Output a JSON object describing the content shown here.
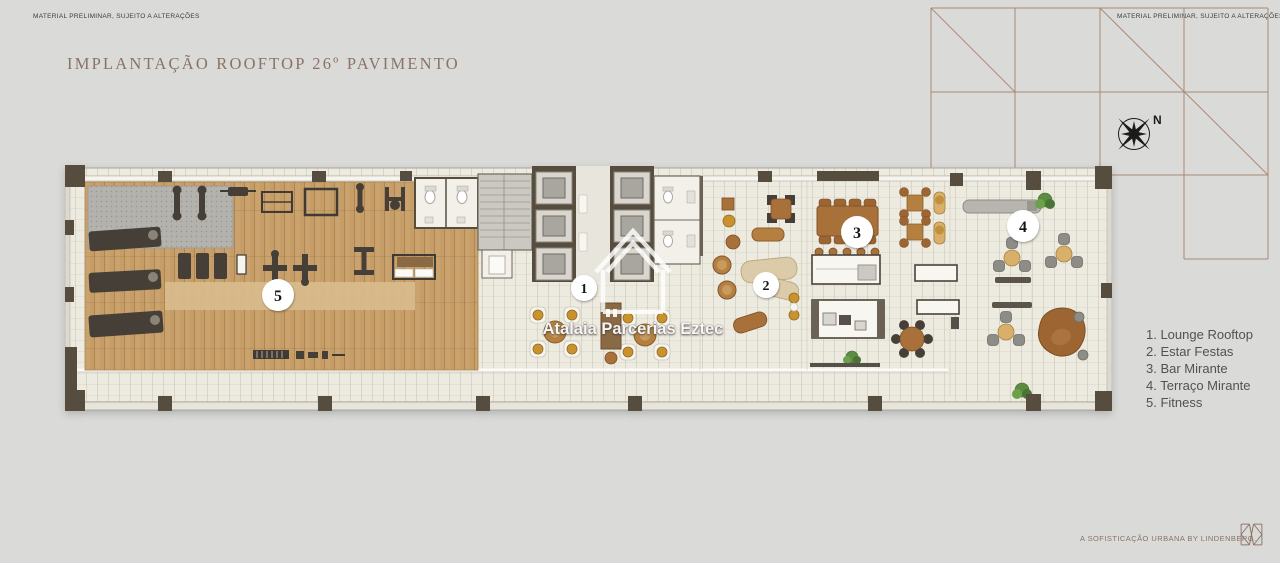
{
  "header": {
    "disclaimer_left": "MATERIAL PRELIMINAR, SUJEITO A ALTERAÇÕES",
    "disclaimer_right": "MATERIAL PRELIMINAR, SUJEITO A ALTERAÇÕES",
    "title": "IMPLANTAÇÃO ROOFTOP 26º PAVIMENTO"
  },
  "compass": {
    "north_label": "N"
  },
  "plan": {
    "badges": [
      {
        "number": "1"
      },
      {
        "number": "2"
      },
      {
        "number": "3"
      },
      {
        "number": "4"
      },
      {
        "number": "5"
      }
    ]
  },
  "watermark": {
    "text": "Atalaia Parcerias Eztec"
  },
  "legend": {
    "items": [
      "1. Lounge Rooftop",
      "2. Estar Festas",
      "3. Bar Mirante",
      "4. Terraço Mirante",
      "5. Fitness"
    ]
  },
  "footer": {
    "tagline": "A SOFISTICAÇÃO URBANA BY LINDENBERG."
  },
  "colors": {
    "accent": "#8b7365",
    "grid-line": "#a5836b",
    "legend-text": "#525252",
    "disclaimer-text": "#3c3c3c",
    "compass": "#1b1b1b",
    "wood": "#c69d66",
    "floor": "#edeae0",
    "wall-dark": "#564d3f",
    "furniture-brown": "#a9713a",
    "furniture-gold": "#c8922f"
  }
}
